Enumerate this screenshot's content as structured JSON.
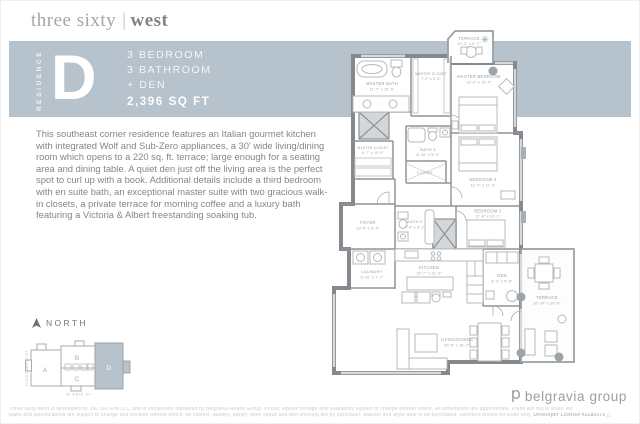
{
  "brand": {
    "logo_part1": "three sixty",
    "logo_separator": "|",
    "logo_part2": "west"
  },
  "banner": {
    "bg_color": "#b6c2cc",
    "residence_vertical": "RESIDENCE",
    "letter": "D",
    "line1": "3 BEDROOM",
    "line2": "3 BATHROOM",
    "line3": "+ DEN",
    "sqft": "2,396 SQ FT"
  },
  "description": "This southeast corner residence features an Italian gourmet kitchen with integrated Wolf and Sub-Zero appliances, a 30' wide living/dining room which opens to a 220 sq. ft. terrace; large enough for a seating area and dining table. A quiet den just off the living area is the perfect spot to curl up with a book. Additional details include a third bedroom with en suite bath, an exceptional master suite with two gracious walk-in closets, a private terrace for morning coffee and a luxury bath featuring a Victoria & Albert freestanding soaking tub.",
  "floorplan": {
    "rooms": {
      "terrace_top": {
        "name": "TERRACE",
        "dims": "10'-2\" x 6'-7\""
      },
      "master_bath": {
        "name": "MASTER BATH",
        "dims": "11'-7\" x 10'-6\""
      },
      "master_closet_a": {
        "name": "MASTER CLOSET",
        "dims": "7'-2\" x 6'-3\""
      },
      "master_bedroom": {
        "name": "MASTER BEDROOM",
        "dims": "13'-0\" x 15'-0\""
      },
      "bedroom_3": {
        "name": "BEDROOM 3",
        "dims": "12'-4\" x 11'-3\""
      },
      "bedroom_2": {
        "name": "BEDROOM 2",
        "dims": "11'-8\" x 12'-1\""
      },
      "bath_3": {
        "name": "BATH 3",
        "dims": "8'-10\" x 5'-0\""
      },
      "closet": {
        "name": "CLOSET",
        "dims": ""
      },
      "master_closet_b": {
        "name": "MASTER CLOSET",
        "dims": "6'-7\" x 10'-9\""
      },
      "foyer": {
        "name": "FOYER",
        "dims": "10'-6\" x 6'-9\""
      },
      "laundry": {
        "name": "LAUNDRY",
        "dims": "6'-10\" x 7'-7\""
      },
      "bath_2": {
        "name": "BATH 2",
        "dims": "7'-4\" x 8'-2\""
      },
      "kitchen": {
        "name": "KITCHEN",
        "dims": "15'-7\" x 12'-0\""
      },
      "den": {
        "name": "DEN",
        "dims": "8'-0\" x 9'-8\""
      },
      "living_dining": {
        "name": "LIVING/DINING",
        "dims": "30'-0\" x 19'-2\""
      },
      "terrace_main": {
        "name": "TERRACE",
        "dims": "10'-10\" x 20'-0\""
      }
    }
  },
  "keyplan": {
    "north_label": "NORTH",
    "street_left": "N KINGSBURY ST",
    "street_bottom": "W ERIE ST",
    "unit_a": "A",
    "unit_b": "B",
    "unit_c": "C",
    "unit_d": "D",
    "highlight_unit": "D",
    "highlight_color": "#b6c2cc"
  },
  "footer": {
    "logo_mark": "b",
    "logo_text": "belgravia group",
    "disclaimer_line1": "Three Sixty West is developed by 360 360 Erie LLC and is exclusively marketed by Belgravia Realty Group. Prices, square footage and availability subject to change without notice. All dimensions are approximate. Plans are not to scale. All",
    "disclaimer_line2": "plans and specifications are subject to change and revision without notice. All closets, laundry, pantry, work space and den shelving are by purchaser. Washer and dryer able to be purchased. Furniture shown for scale only.",
    "license": "Developer License #2189373"
  }
}
